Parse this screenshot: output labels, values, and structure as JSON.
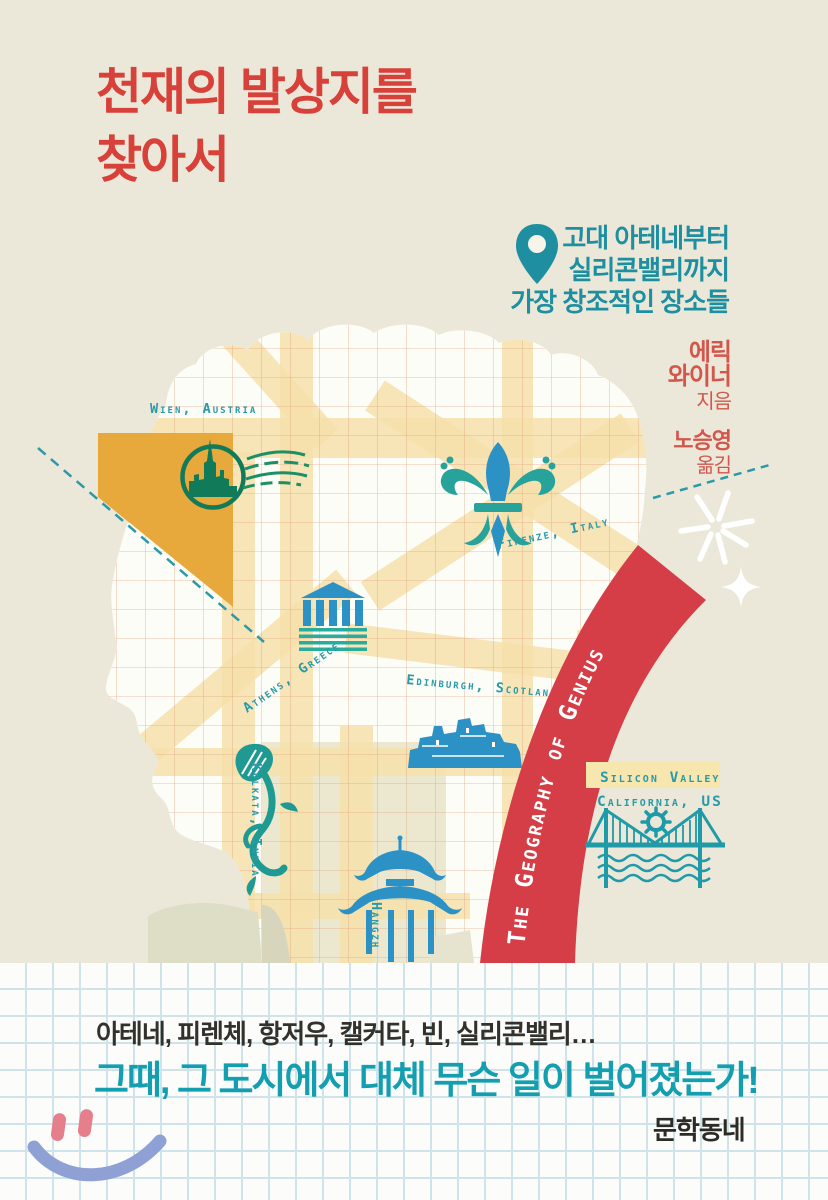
{
  "cover": {
    "title_line1": "천재의 발상지를",
    "title_line2": "찾아서",
    "subtitle_line1": "고대 아테네부터",
    "subtitle_line2": "실리콘밸리까지",
    "subtitle_line3": "가장 창조적인 장소들",
    "author_line1": "에릭",
    "author_line2": "와이너",
    "author_role": "지음",
    "translator_name": "노승영",
    "translator_role": "옮김"
  },
  "map": {
    "labels": {
      "wien": "Wien, Austria",
      "firenze": "Firenze, Italy",
      "athens": "Athens, Greece",
      "edinburgh": "Edinburgh, Scotland",
      "kolkata": "Kolkata, India",
      "hangzhou": "Hangzh",
      "silicon_valley_line1": "Silicon Valley",
      "silicon_valley_line2": "California, US"
    }
  },
  "band": {
    "text": "The Geography of Genius"
  },
  "footer": {
    "line1": "아테네, 피렌체, 항저우, 캘커타, 빈, 실리콘밸리…",
    "line2": "그때, 그 도시에서 대체 무슨 일이 벌어졌는가!",
    "publisher": "문학동네"
  },
  "colors": {
    "background_cream": "#ece8d9",
    "title_red": "#d8413a",
    "subtitle_teal": "#1e8fa0",
    "label_teal": "#2a9aa8",
    "band_red": "#d63e47",
    "street_yellow": "#f6e1ab",
    "mustard": "#e7a83c",
    "icon_blue": "#2c92c6",
    "stamp_green": "#117a58",
    "footer_teal": "#149fb1",
    "smile_blue": "#8fa0d5",
    "smile_eye_pink": "#e57f8c"
  }
}
